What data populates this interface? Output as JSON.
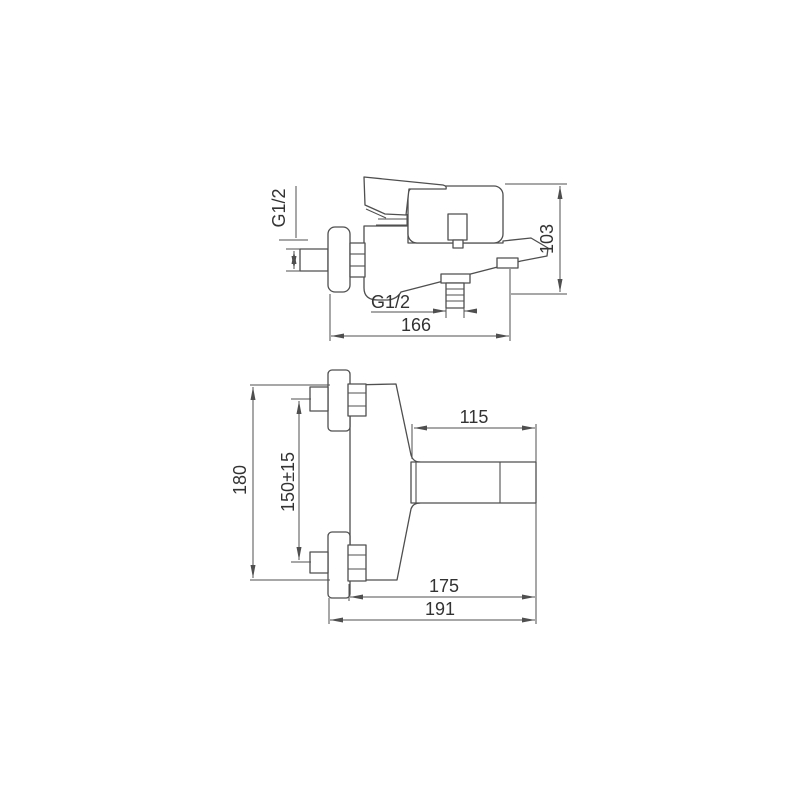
{
  "colors": {
    "background": "#ffffff",
    "line": "#4f4f4f",
    "text": "#333333"
  },
  "side_view": {
    "inlet_thread": "G1/2",
    "outlet_thread": "G1/2",
    "height_dim": "103",
    "reach_dim": "166"
  },
  "plan_view": {
    "overall_height_dim": "180",
    "inlet_spacing_dim": "150±15",
    "spout_length_dim": "115",
    "body_depth_dim": "175",
    "overall_depth_dim": "191"
  }
}
